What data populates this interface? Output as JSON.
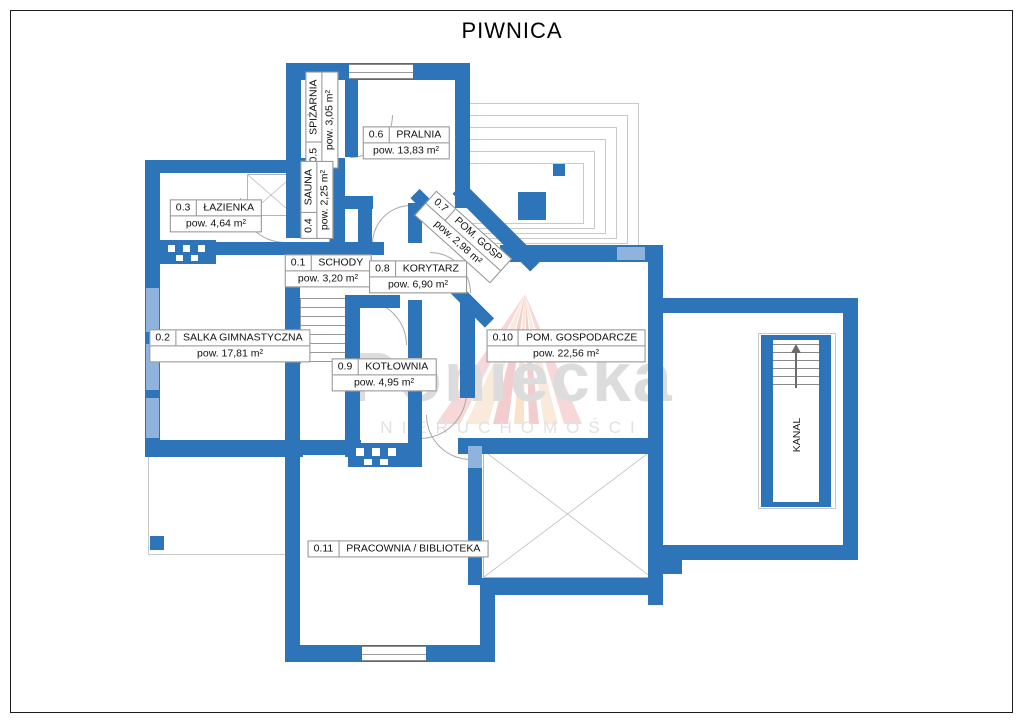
{
  "title": "PIWNICA",
  "watermark": {
    "name": "Poniecka",
    "subtitle": "NIERUCHOMOŚCI"
  },
  "colors": {
    "wall": "#2e74b8",
    "window": "#8fb3dc",
    "line": "#c9c9c9",
    "xline": "#b5b5b5",
    "label_border": "#8f8f8f",
    "watermark": "#dcdcdc",
    "ink": "#111111"
  },
  "rooms": [
    {
      "id": "0.1",
      "name": "SCHODY",
      "area": "pow. 3,20 m²"
    },
    {
      "id": "0.2",
      "name": "SALKA GIMNASTYCZNA",
      "area": "pow. 17,81 m²"
    },
    {
      "id": "0.3",
      "name": "ŁAZIENKA",
      "area": "pow. 4,64 m²"
    },
    {
      "id": "0.4",
      "name": "SAUNA",
      "area": "pow. 2,25 m²"
    },
    {
      "id": "0.5",
      "name": "SPIŻARNIA",
      "area": "pow. 3,05 m²"
    },
    {
      "id": "0.6",
      "name": "PRALNIA",
      "area": "pow. 13,83 m²"
    },
    {
      "id": "0.7",
      "name": "POM. GOSP",
      "area": "pow. 2,98 m²"
    },
    {
      "id": "0.8",
      "name": "KORYTARZ",
      "area": "pow. 6,90 m²"
    },
    {
      "id": "0.9",
      "name": "KOTŁOWNIA",
      "area": "pow. 4,95 m²"
    },
    {
      "id": "0.10",
      "name": "POM. GOSPODARCZE",
      "area": "pow. 22,56 m²"
    },
    {
      "id": "0.11",
      "name": "PRACOWNIA / BIBLIOTEKA",
      "area": ""
    }
  ],
  "annotations": {
    "kanal": "KANAL"
  }
}
